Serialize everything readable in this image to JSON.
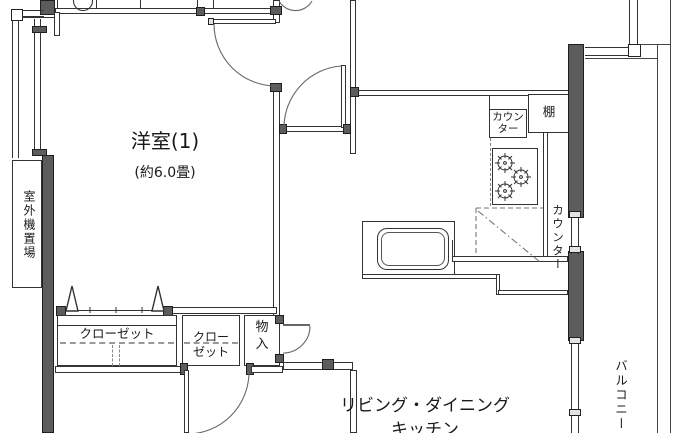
{
  "floorplan": {
    "rooms": {
      "western_room_1": {
        "label": "洋室(1)",
        "size": "(約6.0畳)"
      },
      "ldk": {
        "label_line1": "リビング・ダイニング",
        "label_line2": "キッチン"
      },
      "balcony": {
        "label": "バルコニー"
      },
      "outdoor_unit_space": {
        "label": "室外機置場"
      }
    },
    "storage": {
      "closet_main": {
        "label": "クローゼット"
      },
      "closet_small": {
        "label_line1": "クロー",
        "label_line2": "ゼット"
      },
      "storage_compartment": {
        "label_line1": "物",
        "label_line2": "入"
      }
    },
    "kitchen": {
      "counter_upper": {
        "label_line1": "カウン",
        "label_line2": "ター"
      },
      "counter_side": {
        "label": "カウンター"
      },
      "shelf": {
        "label": "棚"
      }
    },
    "colors": {
      "background": "#ffffff",
      "line": "#333333",
      "wall_fill": "#5c5c5c",
      "door_arc": "#666666"
    }
  }
}
